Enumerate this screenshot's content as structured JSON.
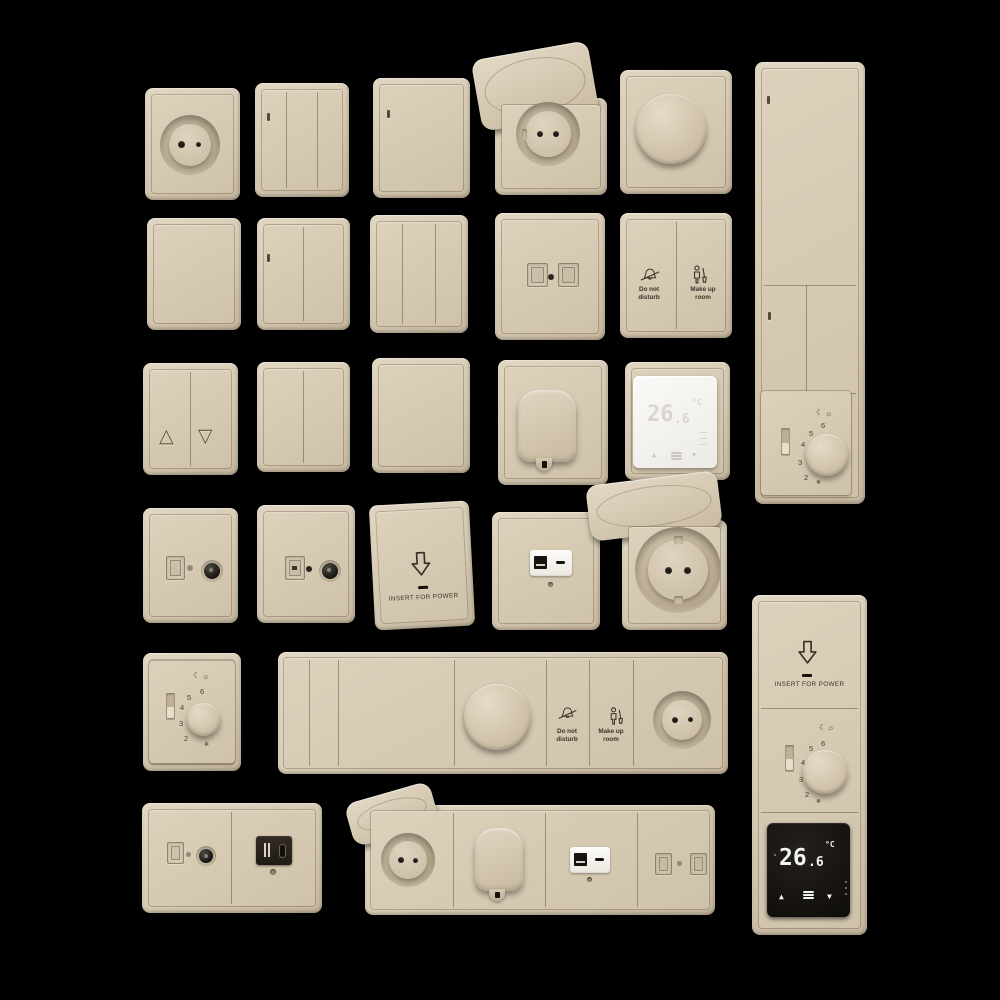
{
  "scene": {
    "description": "3D render set of beige hotel-style wall switches, power sockets, dimmers, thermostats, USB/TV outlets and key-card holders arranged in a grid on a black background",
    "background": "#000000"
  },
  "colors": {
    "plate_beige": "#d5c8b1",
    "plate_highlight": "#e1d6c2",
    "plate_shadow": "#c6b79e",
    "engraving": "#3a332a",
    "display_black": "#12100d",
    "display_white": "#f7f5f1",
    "digits_on_black": "#f4f4f2",
    "digits_on_white": "#d9d6d0",
    "module_black": "#241e18",
    "module_white": "#f7f5f2"
  },
  "labels": {
    "dnd1": "Do not",
    "dnd2": "disturb",
    "mur1": "Make up",
    "mur2": "room",
    "insert": "INSERT FOR POWER"
  },
  "dial": {
    "moon": "☾",
    "sun": "☼",
    "frost": "❄",
    "n2": "2",
    "n3": "3",
    "n4": "4",
    "n5": "5",
    "n6": "6"
  },
  "display": {
    "int": "26",
    "dec": ".6",
    "unit": "°C",
    "up": "▲",
    "down": "▼"
  },
  "blinds": {
    "up": "△",
    "down": "▽"
  },
  "panels": [
    {
      "name": "power-socket-round",
      "row": 1
    },
    {
      "name": "switch-3-gang-indicator",
      "row": 1
    },
    {
      "name": "switch-1-gang-indicator",
      "row": 1
    },
    {
      "name": "power-socket-flip-lid",
      "row": 1
    },
    {
      "name": "rotary-dimmer",
      "row": 1
    },
    {
      "name": "vertical-panel-switches-thermostat-dial",
      "row": 1
    },
    {
      "name": "switch-1-gang-blank",
      "row": 2
    },
    {
      "name": "switch-2-gang-indicator",
      "row": 2
    },
    {
      "name": "switch-3-gang",
      "row": 2
    },
    {
      "name": "data-socket-double",
      "row": 2
    },
    {
      "name": "do-not-disturb-make-up-room-switch",
      "row": 2
    },
    {
      "name": "blinds-switch",
      "row": 3
    },
    {
      "name": "switch-2-gang",
      "row": 3
    },
    {
      "name": "switch-1-gang",
      "row": 3
    },
    {
      "name": "moulded-cable-outlet",
      "row": 3
    },
    {
      "name": "digital-thermostat-white",
      "row": 3
    },
    {
      "name": "tv-data-socket",
      "row": 4
    },
    {
      "name": "tv-rj45-socket",
      "row": 4
    },
    {
      "name": "key-card-holder",
      "row": 4
    },
    {
      "name": "usb-charger-white",
      "row": 4
    },
    {
      "name": "power-socket-flip-lid-large",
      "row": 4
    },
    {
      "name": "thermostat-dial-plate",
      "row": 5
    },
    {
      "name": "horizontal-panel-dimmer-service-socket",
      "row": 5
    },
    {
      "name": "vertical-panel-keycard-thermostat-display",
      "row": 5
    },
    {
      "name": "tv-usb-double-plate",
      "row": 6
    },
    {
      "name": "horizontal-panel-socket-outlet-usb-data",
      "row": 6
    }
  ]
}
